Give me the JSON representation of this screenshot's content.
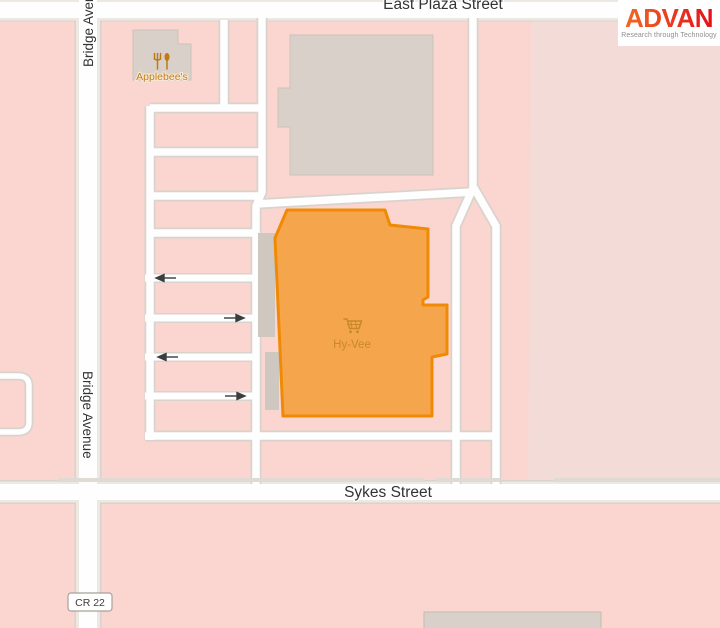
{
  "map": {
    "street_labels": {
      "east_plaza": "East Plaza Street",
      "bridge_avenue_top": "Bridge Aven",
      "bridge_avenue_mid": "Bridge Avenue",
      "sykes": "Sykes Street"
    },
    "route_badge": "CR 22",
    "pois": [
      {
        "name": "Applebee's",
        "icon": "restaurant-fork-spoon-icon"
      },
      {
        "name": "Hy-Vee",
        "icon": "shopping-cart-icon"
      }
    ],
    "colors": {
      "background_pink": "#FBD5CF",
      "parcel_light_pink": "#F3DBD7",
      "road_fill": "#FEFEFE",
      "road_casing": "#D8D3CD",
      "building_gray": "#D9D1C9",
      "building_border_gray": "#CBC2B9",
      "highlight_fill": "#F5A54B",
      "highlight_border": "#F08A05",
      "poi_text_orange": "#C2801F",
      "hyvee_text_orange": "#C9872E",
      "label_text": "#333333"
    }
  },
  "logo": {
    "brand": "ADVAN",
    "tagline": "Research through Technology",
    "color_left": "#F26822",
    "color_right": "#E3111B",
    "tagline_color": "#8E8E8E"
  }
}
